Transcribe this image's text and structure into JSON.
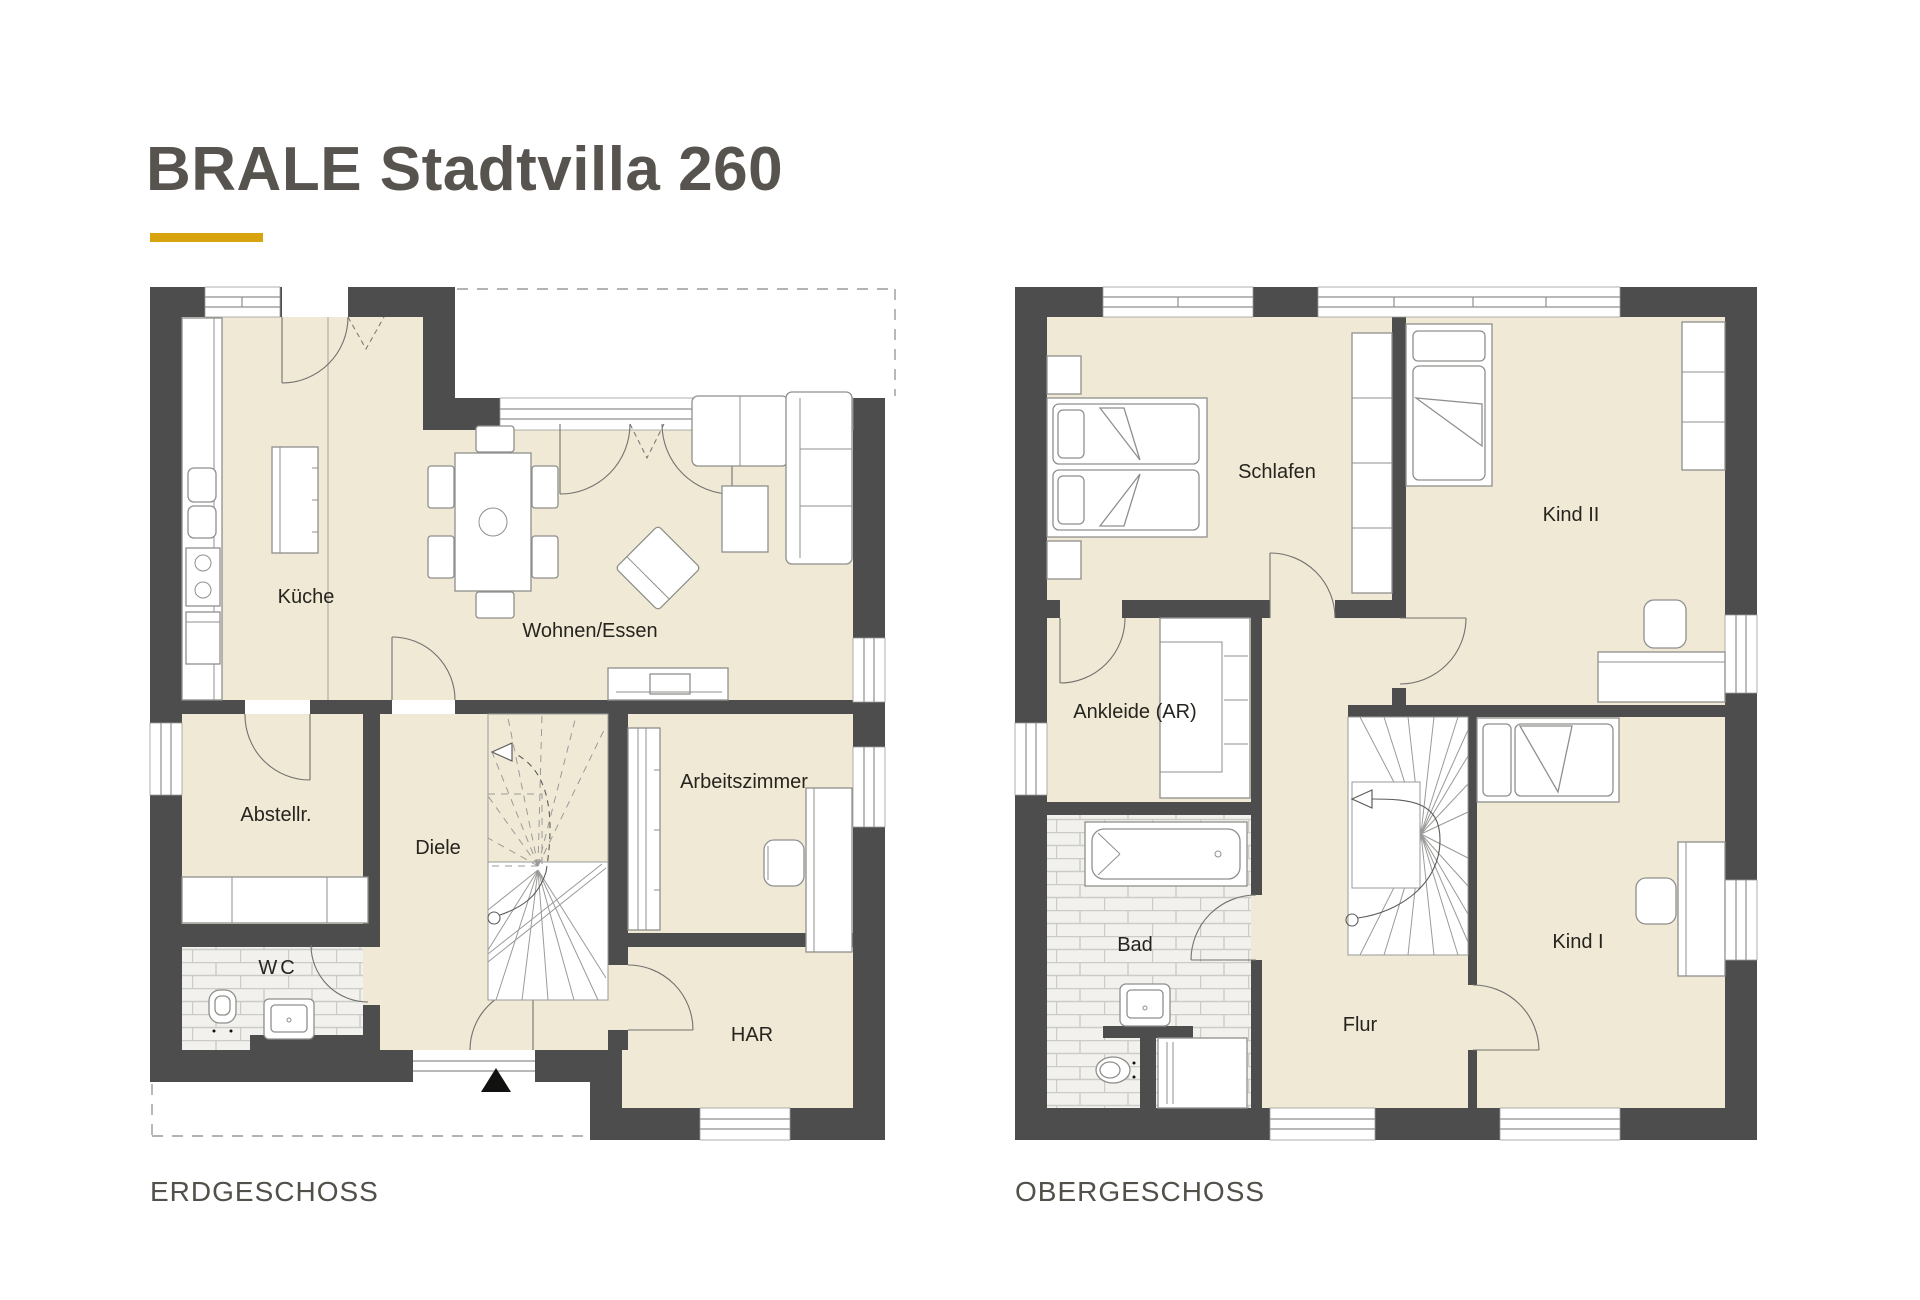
{
  "title": "BRALE Stadtvilla 260",
  "colors": {
    "accent": "#d7a40f",
    "wall": "#4d4d4d",
    "floor_fill": "#f0e9d6",
    "tile_fill": "#f2f1ed",
    "title_text": "#57534e",
    "label_text": "#26241e"
  },
  "floors": [
    {
      "label": "ERDGESCHOSS",
      "rooms": [
        {
          "name": "Küche"
        },
        {
          "name": "Wohnen/Essen"
        },
        {
          "name": "Abstellr."
        },
        {
          "name": "Diele"
        },
        {
          "name": "WC"
        },
        {
          "name": "Arbeitszimmer"
        },
        {
          "name": "HAR"
        }
      ]
    },
    {
      "label": "OBERGESCHOSS",
      "rooms": [
        {
          "name": "Schlafen"
        },
        {
          "name": "Kind II"
        },
        {
          "name": "Ankleide (AR)"
        },
        {
          "name": "Bad"
        },
        {
          "name": "Flur"
        },
        {
          "name": "Kind I"
        }
      ]
    }
  ]
}
